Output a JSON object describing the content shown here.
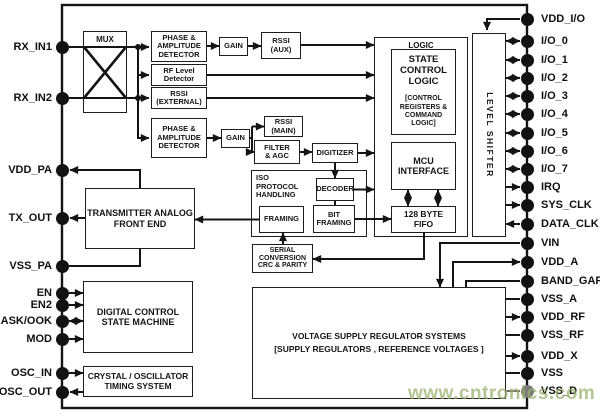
{
  "watermark": "www.cntronics.com",
  "blocks": {
    "mux": "MUX",
    "phase_amp_detector_1": "PHASE &\nAMPLITUDE\nDETECTOR",
    "gain_1": "GAIN",
    "rssi_aux": "RSSI\n(AUX)",
    "rf_level_detector": "RF Level\nDetector",
    "rssi_external": "RSSI\n(EXTERNAL)",
    "phase_amp_detector_2": "PHASE &\nAMPLITUDE\nDETECTOR",
    "gain_2": "GAIN",
    "rssi_main": "RSSI\n(MAIN)",
    "filter_agc": "FILTER\n& AGC",
    "digitizer": "DIGITIZER",
    "iso_protocol_handling": "ISO\nPROTOCOL\nHANDLING",
    "decoder": "DECODER",
    "framing": "FRAMING",
    "bit_framing": "BIT\nFRAMING",
    "serial_conversion": "SERIAL\nCONVERSION\nCRC & PARITY",
    "transmitter_analog_front_end": "TRANSMITTER ANALOG\nFRONT END",
    "digital_control_state_machine": "DIGITAL CONTROL\nSTATE MACHINE",
    "crystal_oscillator_timing": "CRYSTAL / OSCILLATOR\nTIMING SYSTEM",
    "logic": "LOGIC",
    "state_control_logic": "STATE\nCONTROL\nLOGIC",
    "state_control_logic_sub": "[CONTROL\nREGISTERS &\nCOMMAND\nLOGIC]",
    "mcu_interface": "MCU\nINTERFACE",
    "fifo": "128 BYTE\nFIFO",
    "level_shifter": "LEVEL SHIFTER",
    "voltage_regulator": "VOLTAGE SUPPLY REGULATOR SYSTEMS\n[SUPPLY REGULATORS , REFERENCE VOLTAGES ]"
  },
  "pins": {
    "left": [
      {
        "name": "RX_IN1"
      },
      {
        "name": "RX_IN2"
      },
      {
        "name": "VDD_PA"
      },
      {
        "name": "TX_OUT"
      },
      {
        "name": "VSS_PA"
      },
      {
        "name": "EN"
      },
      {
        "name": "EN2"
      },
      {
        "name": "ASK/OOK"
      },
      {
        "name": "MOD"
      },
      {
        "name": "OSC_IN"
      },
      {
        "name": "OSC_OUT"
      }
    ],
    "right": [
      {
        "name": "VDD_I/O"
      },
      {
        "name": "I/O_0"
      },
      {
        "name": "I/O_1"
      },
      {
        "name": "I/O_2"
      },
      {
        "name": "I/O_3"
      },
      {
        "name": "I/O_4"
      },
      {
        "name": "I/O_5"
      },
      {
        "name": "I/O_6"
      },
      {
        "name": "I/O_7"
      },
      {
        "name": "IRQ"
      },
      {
        "name": "SYS_CLK"
      },
      {
        "name": "DATA_CLK"
      },
      {
        "name": "VIN"
      },
      {
        "name": "VDD_A"
      },
      {
        "name": "BAND_GAP"
      },
      {
        "name": "VSS_A"
      },
      {
        "name": "VDD_RF"
      },
      {
        "name": "VSS_RF"
      },
      {
        "name": "VDD_X"
      },
      {
        "name": "VSS"
      },
      {
        "name": "VSS_D"
      }
    ]
  }
}
